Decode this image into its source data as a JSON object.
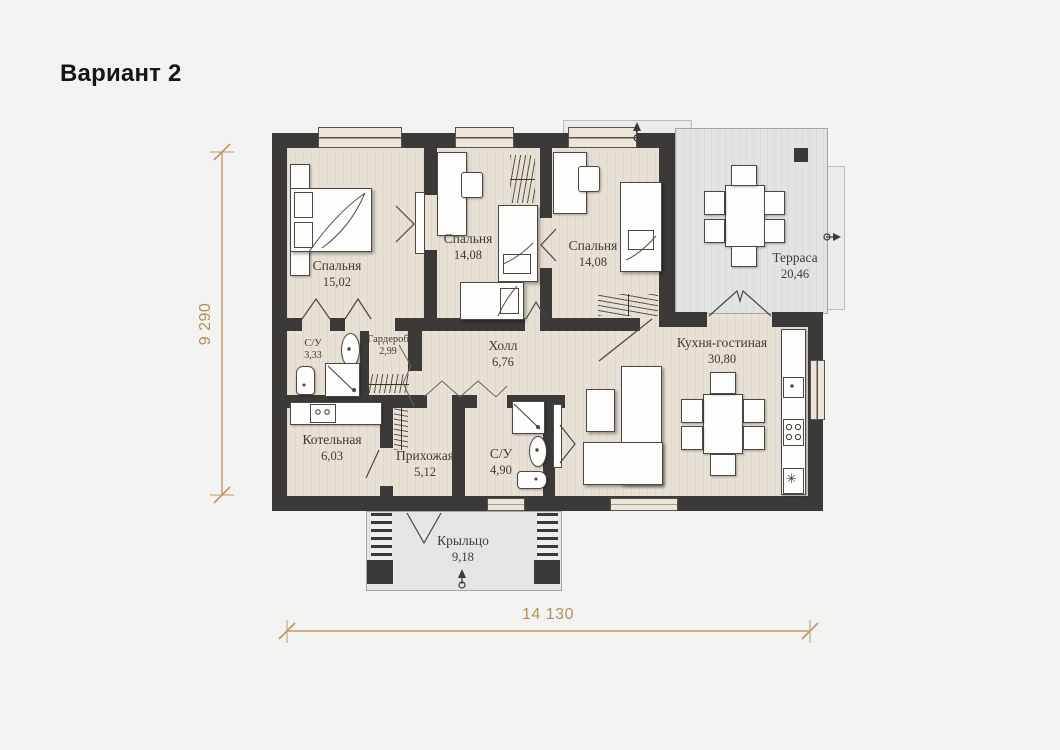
{
  "title": "Вариант 2",
  "plan": {
    "rooms": [
      {
        "name": "Спальня",
        "area": "15,02"
      },
      {
        "name": "Спальня",
        "area": "14,08"
      },
      {
        "name": "Спальня",
        "area": "14,08"
      },
      {
        "name": "Терраса",
        "area": "20,46"
      },
      {
        "name": "С/У",
        "area": "3,33"
      },
      {
        "name": "Гардероб",
        "area": "2,99"
      },
      {
        "name": "Холл",
        "area": "6,76"
      },
      {
        "name": "Кухня-гостиная",
        "area": "30,80"
      },
      {
        "name": "Котельная",
        "area": "6,03"
      },
      {
        "name": "Прихожая",
        "area": "5,12"
      },
      {
        "name": "С/У",
        "area": "4,90"
      },
      {
        "name": "Крыльцо",
        "area": "9,18"
      }
    ],
    "dimensions": {
      "width": "14 130",
      "height": "9 290"
    },
    "icons": {
      "cooktop_star": "✳"
    },
    "colors": {
      "wall": "#3b3a38",
      "floor": "#e7e0d4",
      "outdoor_floor": "#e2e3e3",
      "dimension": "#bf9a6a",
      "background": "#f3f3f2"
    }
  }
}
